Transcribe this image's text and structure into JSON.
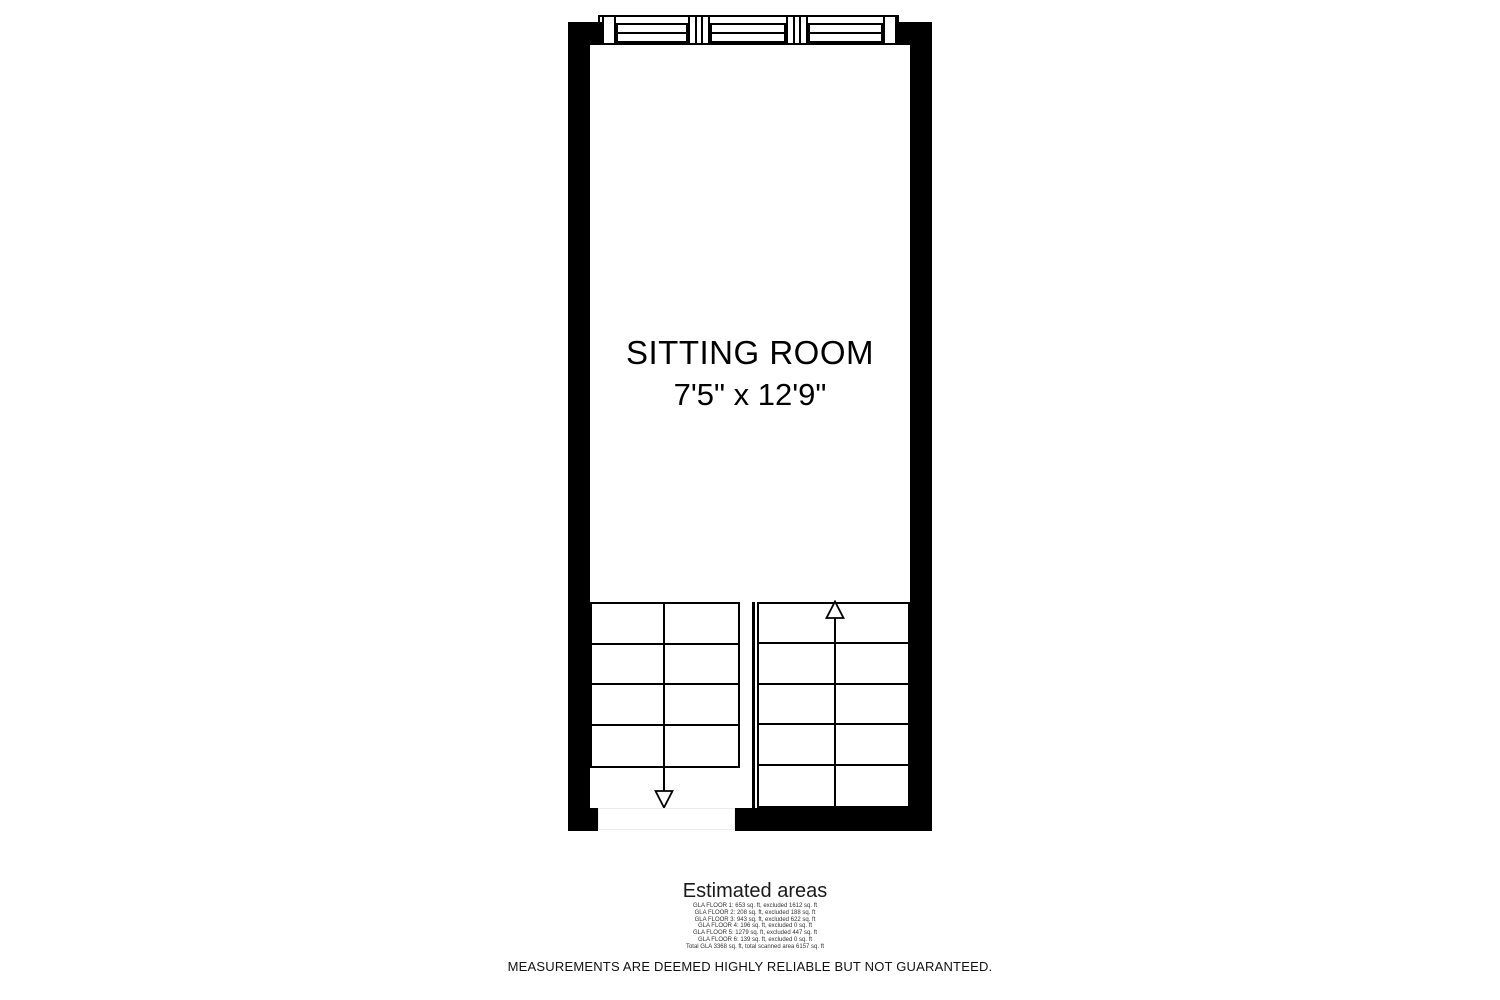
{
  "floor_plan": {
    "room": {
      "name": "SITTING ROOM",
      "dimensions": "7'5\" x 12'9\""
    },
    "stairs": {
      "left_flight": {
        "rows": 4,
        "direction": "down"
      },
      "right_flight": {
        "rows": 5,
        "direction": "up"
      }
    },
    "windows": {
      "sections": 3
    },
    "colors": {
      "wall": "#000000",
      "background": "#ffffff"
    }
  },
  "estimated_areas": {
    "title": "Estimated areas",
    "lines": [
      "GLA FLOOR 1: 653 sq. ft, excluded 1612 sq. ft",
      "GLA FLOOR 2: 208 sq. ft, excluded 188 sq. ft",
      "GLA FLOOR 3: 943 sq. ft, excluded 622 sq. ft",
      "GLA FLOOR 4: 196 sq. ft, excluded 0 sq. ft",
      "GLA FLOOR 5: 1279 sq. ft, excluded 447 sq. ft",
      "GLA FLOOR 6: 139 sq. ft, excluded 0 sq. ft",
      "Total GLA 3368 sq. ft, total scanned area 6157 sq. ft"
    ]
  },
  "disclaimer": "MEASUREMENTS ARE DEEMED HIGHLY RELIABLE BUT NOT GUARANTEED."
}
